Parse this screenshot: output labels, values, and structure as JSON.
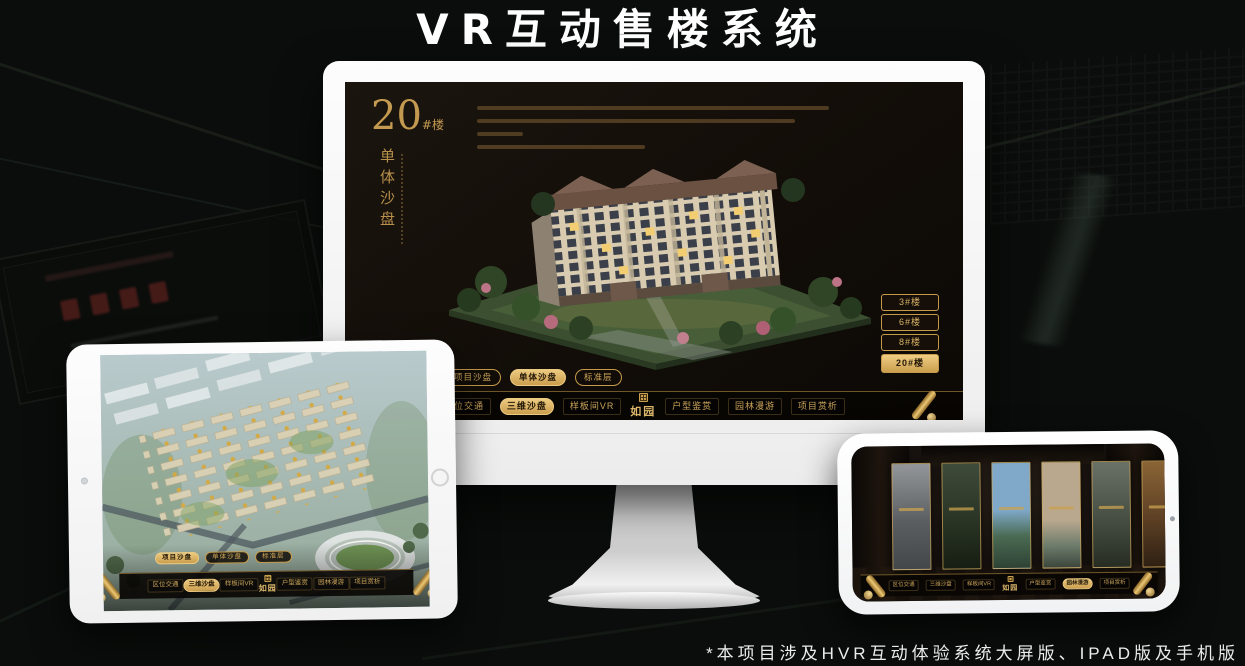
{
  "title": "VR互动售楼系统",
  "footnote": "*本项目涉及HVR互动体验系统大屏版、IPAD版及手机版",
  "brand_logo": "如园",
  "view_tabs": [
    "项目沙盘",
    "单体沙盘",
    "标准层"
  ],
  "nav_items": [
    "区位交通",
    "三维沙盘",
    "样板间VR",
    "户型鉴赏",
    "园林漫游",
    "项目赏析"
  ],
  "monitor": {
    "headline_no": "20",
    "headline_unit": "#楼",
    "headline_sub": "单体沙盘",
    "building_buttons": [
      "3#楼",
      "6#楼",
      "8#楼",
      "20#楼"
    ],
    "active_building": "20#楼",
    "active_tab": "单体沙盘",
    "active_nav": "三维沙盘"
  },
  "ipad": {
    "active_tab": "项目沙盘",
    "active_nav": "三维沙盘"
  },
  "phone": {
    "active_nav": "园林漫游"
  },
  "colors": {
    "gold": "#C9A35A",
    "gold_active": "#ECCA80",
    "dark_on_gold": "#241807",
    "screen_bg": "#15100B",
    "nav_bg": "#080603",
    "title_white": "#FFFFFF"
  }
}
